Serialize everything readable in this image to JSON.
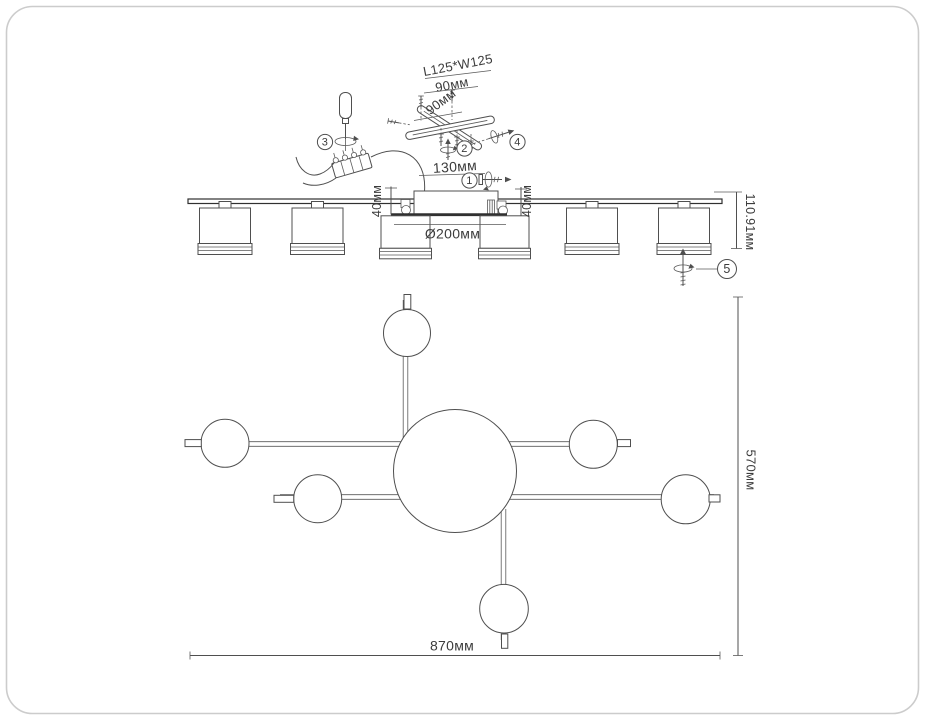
{
  "palette": {
    "background": "#ffffff",
    "frame_border": "#cccccc",
    "line": "#4f4f4f",
    "line_dark": "#303030",
    "text": "#3c3c3c"
  },
  "assembly": {
    "plate_size": "L125*W125",
    "hole_pitch_a": "90мм",
    "hole_pitch_b": "90мм",
    "bracket_offset": "130мм",
    "step_1": "1",
    "step_2": "2",
    "step_3": "3",
    "step_4": "4",
    "step_5": "5"
  },
  "side_view": {
    "canopy_height_left": "40мм",
    "canopy_height_right": "40мм",
    "total_height": "110.91мм",
    "center_shade_diameter": "Ø200мм"
  },
  "plan_view": {
    "overall_width": "870мм",
    "overall_depth": "570мм"
  }
}
